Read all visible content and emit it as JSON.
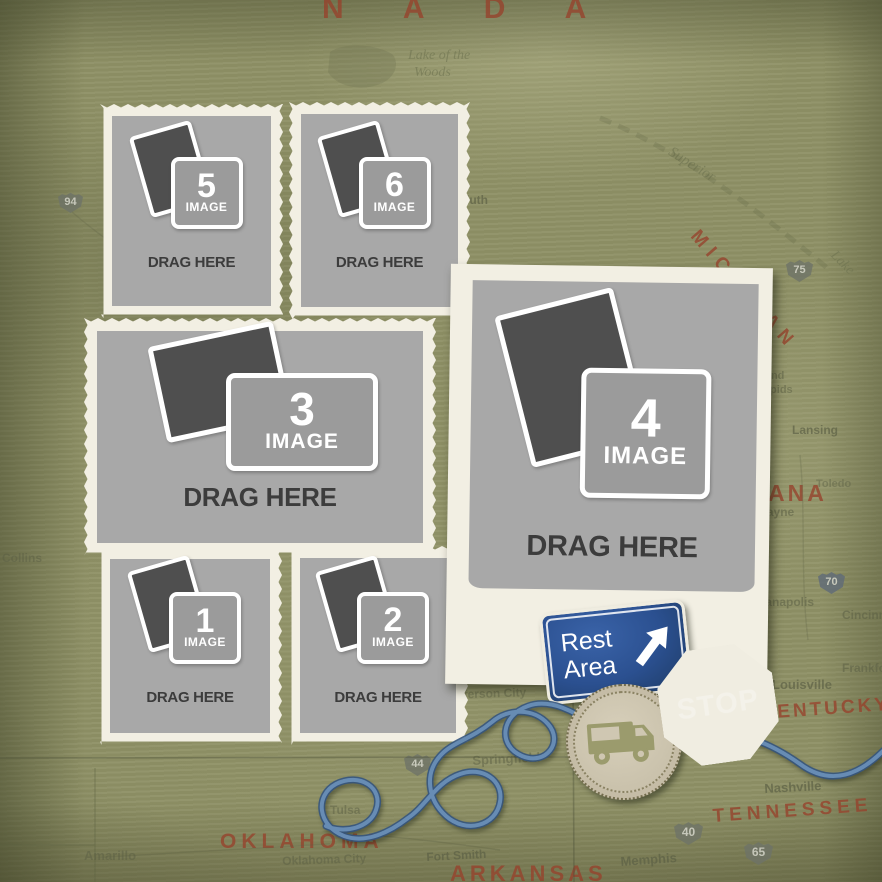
{
  "frames": [
    {
      "number": "1",
      "image_label": "IMAGE",
      "drag_label": "DRAG HERE"
    },
    {
      "number": "2",
      "image_label": "IMAGE",
      "drag_label": "DRAG HERE"
    },
    {
      "number": "3",
      "image_label": "IMAGE",
      "drag_label": "DRAG HERE"
    },
    {
      "number": "4",
      "image_label": "IMAGE",
      "drag_label": "DRAG HERE"
    },
    {
      "number": "5",
      "image_label": "IMAGE",
      "drag_label": "DRAG HERE"
    },
    {
      "number": "6",
      "image_label": "IMAGE",
      "drag_label": "DRAG HERE"
    }
  ],
  "stickers": {
    "rest_area": {
      "line1": "Rest",
      "line2": "Area",
      "arrow_icon": "up-right-arrow-icon"
    },
    "stop_sign": {
      "label": "STOP"
    },
    "camper_badge": {
      "icon": "rv-camper-icon"
    }
  },
  "map": {
    "country_label": "N  A  D  A",
    "regions": {
      "michigan": "MICHIGAN",
      "indiana_partial": "ANA",
      "kentucky": "KENTUCKY",
      "tennessee": "TENNESSEE",
      "oklahoma": "OKLAHOMA",
      "arkansas": "ARKANSAS"
    },
    "cities": {
      "duluth": "Duluth",
      "collins": "Collins",
      "lansing": "Lansing",
      "toledo": "Toledo",
      "wayne": "Wayne",
      "grand": "Grand",
      "rapids": "Rapids",
      "indianapolis": "Indianapolis",
      "cincinnati": "Cincinnati",
      "frankfort": "Frankfort",
      "louisville": "Louisville",
      "nashville": "Nashville",
      "memphis": "Memphis",
      "amarillo": "Amarillo",
      "tulsa": "Tulsa",
      "oklahoma_city": "Oklahoma City",
      "fort_smith": "Fort Smith",
      "springfield": "Springfield",
      "jefferson_city": "Jefferson City"
    },
    "lakes": {
      "lake_of_the_woods_line1": "Lake of the",
      "lake_of_the_woods_line2": "Woods",
      "superior": "Superior",
      "lake": "Lake"
    },
    "highways": {
      "i94": "94",
      "i75": "75",
      "i70": "70",
      "i44": "44",
      "i40": "40",
      "i65": "65"
    }
  },
  "colors": {
    "background_olive": "#8f9166",
    "frame_cream": "#f2efe3",
    "placeholder_gray": "#a8a8a8",
    "icon_dark_gray": "#4f4f4f",
    "drag_text": "#3c3c3c",
    "rest_area_blue": "#2b5090",
    "stop_red": "#8c2519",
    "badge_tan": "#c5bca6",
    "rv_olive": "#9b9b6d",
    "string_blue": "#678cb4",
    "map_text_rust": "#97422c"
  }
}
